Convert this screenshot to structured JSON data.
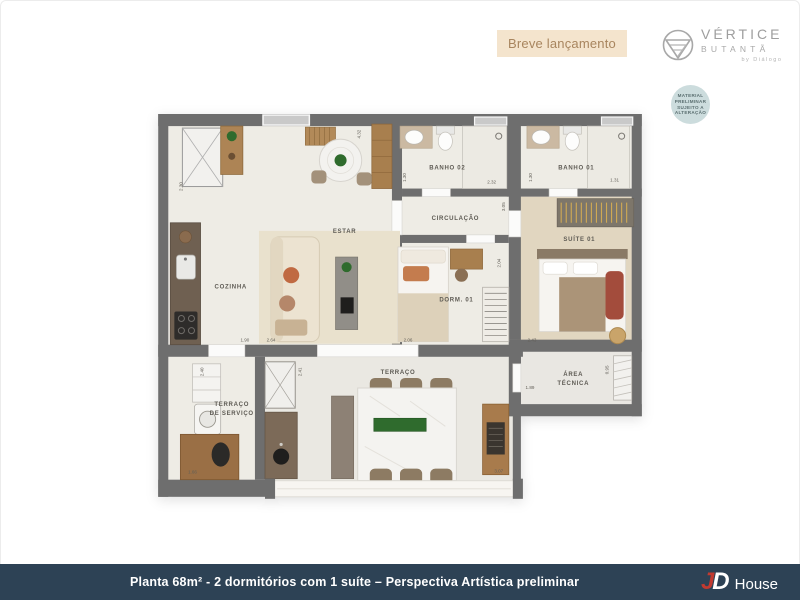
{
  "header": {
    "badge": "Breve lançamento",
    "logo": {
      "line1": "VÉRTICE",
      "line2": "BUTANTÃ",
      "line3": "by Diálogo"
    },
    "disclaimer": {
      "l1": "MATERIAL",
      "l2": "PRELIMINAR",
      "l3": "SUJEITO A",
      "l4": "ALTERAÇÃO"
    }
  },
  "footer": {
    "caption": "Planta 68m² - 2 dormitórios com 1 suíte – Perspectiva Artística preliminar",
    "logo": {
      "j": "J",
      "d": "D",
      "text": "House"
    }
  },
  "colors": {
    "badge_bg": "#f4e4cd",
    "badge_text": "#a8855e",
    "footer_bg": "#2d4255",
    "jd_red": "#c23a30",
    "wall": "#6e6e6e",
    "floor": "#eeece5",
    "suite_floor": "#e1d6c0",
    "wood": "#a87f4e",
    "green": "#2f6b2d",
    "orange": "#c06a42"
  },
  "floorplan": {
    "rooms": [
      {
        "id": "estar",
        "label": "ESTAR",
        "x": 185,
        "y": 118
      },
      {
        "id": "cozinha",
        "label": "COZINHA",
        "x": 72,
        "y": 173
      },
      {
        "id": "banho-02",
        "label": "BANHO 02",
        "x": 287,
        "y": 55
      },
      {
        "id": "banho-01",
        "label": "BANHO 01",
        "x": 415,
        "y": 55
      },
      {
        "id": "circulacao",
        "label": "CIRCULAÇÃO",
        "x": 295,
        "y": 105
      },
      {
        "id": "dorm-01",
        "label": "DORM. 01",
        "x": 296,
        "y": 186
      },
      {
        "id": "suite-01",
        "label": "SUÍTE 01",
        "x": 418,
        "y": 126
      },
      {
        "id": "terraco",
        "label": "TERRAÇO",
        "x": 238,
        "y": 258
      },
      {
        "id": "terraco-servico",
        "label": "TERRAÇO",
        "label2": "DE SERVIÇO",
        "x": 73,
        "y": 290
      },
      {
        "id": "area-tecnica",
        "label": "ÁREA",
        "label2": "TÉCNICA",
        "x": 412,
        "y": 260
      }
    ],
    "dimensions": [
      {
        "v": "2.30",
        "x": 24,
        "y": 72,
        "rot": -90
      },
      {
        "v": "4.32",
        "x": 201,
        "y": 20,
        "rot": -90
      },
      {
        "v": "1.30",
        "x": 246,
        "y": 63,
        "rot": -90
      },
      {
        "v": "2.32",
        "x": 331,
        "y": 69,
        "rot": 0
      },
      {
        "v": "1.30",
        "x": 371,
        "y": 63,
        "rot": -90
      },
      {
        "v": "1.31",
        "x": 453,
        "y": 67,
        "rot": 0
      },
      {
        "v": "3.05",
        "x": 344,
        "y": 92,
        "rot": -90
      },
      {
        "v": "2.04",
        "x": 340,
        "y": 148,
        "rot": -90
      },
      {
        "v": "1.90",
        "x": 86,
        "y": 226,
        "rot": 0
      },
      {
        "v": "2.64",
        "x": 112,
        "y": 226,
        "rot": 0
      },
      {
        "v": "2.06",
        "x": 248,
        "y": 226,
        "rot": 0
      },
      {
        "v": "2.43",
        "x": 371,
        "y": 226,
        "rot": 0
      },
      {
        "v": "2.40",
        "x": 45,
        "y": 256,
        "rot": -90
      },
      {
        "v": "2.41",
        "x": 142,
        "y": 256,
        "rot": -90
      },
      {
        "v": "1.66",
        "x": 34,
        "y": 357,
        "rot": 0
      },
      {
        "v": "3.07",
        "x": 338,
        "y": 356,
        "rot": 0
      },
      {
        "v": "1.89",
        "x": 369,
        "y": 273,
        "rot": 0
      },
      {
        "v": "0.95",
        "x": 447,
        "y": 254,
        "rot": -90
      }
    ]
  }
}
